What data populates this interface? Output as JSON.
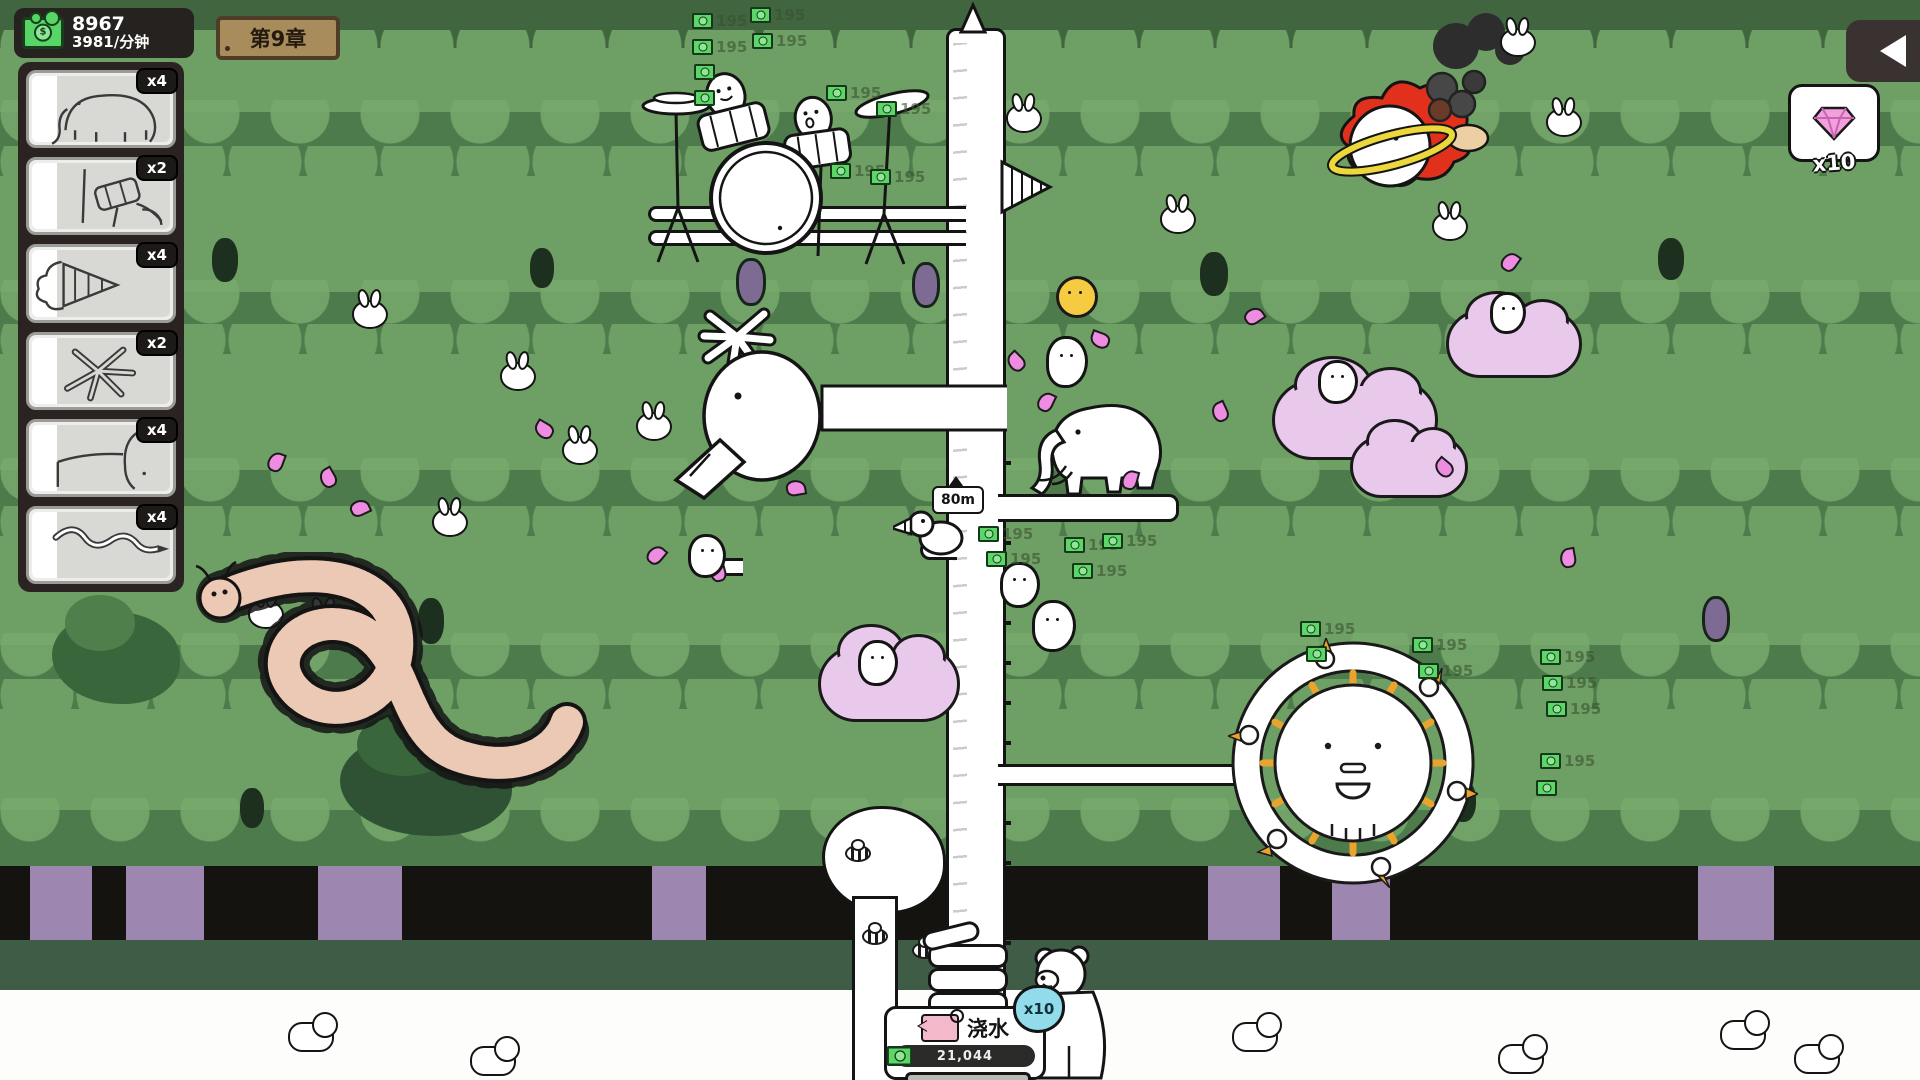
{
  "hud": {
    "money": {
      "amount": "8967",
      "rate": "3981/分钟"
    },
    "chapter_sign": "第9章",
    "gem_panel": {
      "count": "x10"
    }
  },
  "sidebar": {
    "cards": [
      {
        "unit": "mammoth",
        "count": "x4"
      },
      {
        "unit": "drum-kit",
        "count": "x2"
      },
      {
        "unit": "drill",
        "count": "x4"
      },
      {
        "unit": "splat",
        "count": "x2"
      },
      {
        "unit": "goose",
        "count": "x4"
      },
      {
        "unit": "worm",
        "count": "x4"
      }
    ]
  },
  "world": {
    "height_marker": "80m",
    "reward_value": "195"
  },
  "action_panel": {
    "title": "浇水",
    "progress": "21,044",
    "multiplier": "x10"
  }
}
